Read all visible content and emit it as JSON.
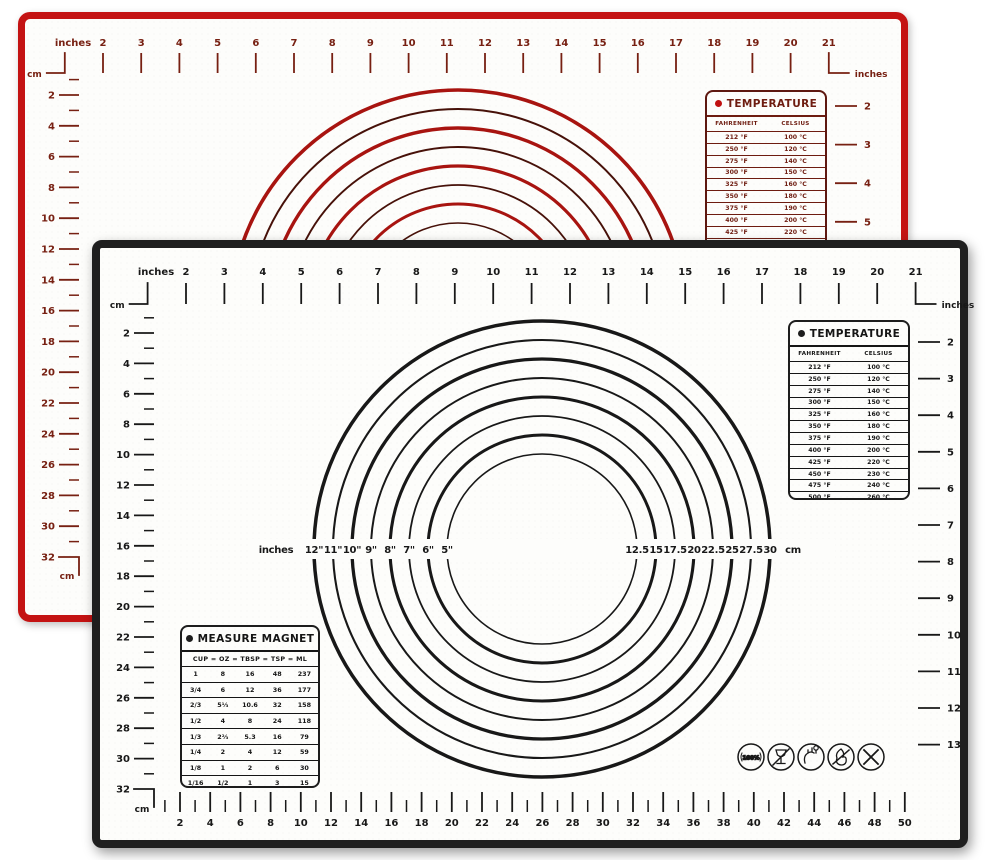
{
  "colors": {
    "red_border": "#c41313",
    "red_ink": "#772012",
    "red_circle_bright": "#a81410",
    "red_circle_dark": "#471109",
    "black_border": "#1f1f1f",
    "black_ink": "#181818",
    "mat_bg": "#fdfdfb"
  },
  "red_mat": {
    "top_ruler": {
      "unit_left": "inches",
      "corner_unit": "cm",
      "numbers": [
        "2",
        "3",
        "4",
        "5",
        "6",
        "7",
        "8",
        "9",
        "10",
        "11",
        "12",
        "13",
        "14",
        "15",
        "16",
        "17",
        "18",
        "19",
        "20",
        "21"
      ],
      "unit_right": "inches"
    },
    "left_ruler": {
      "numbers": [
        "2",
        "4",
        "6",
        "8",
        "10",
        "12",
        "14",
        "16",
        "18",
        "20",
        "22",
        "24",
        "26",
        "28",
        "30",
        "32"
      ],
      "unit": "cm"
    },
    "right_ruler": {
      "numbers": [
        "2",
        "3",
        "4",
        "5",
        "6",
        "7",
        "8",
        "9",
        "10",
        "11",
        "12",
        "13"
      ]
    },
    "temperature_table": {
      "title": "TEMPERATURE",
      "columns": [
        "FAHRENHEIT",
        "CELSIUS"
      ],
      "rows": [
        [
          "212 °F",
          "100 °C"
        ],
        [
          "250 °F",
          "120 °C"
        ],
        [
          "275 °F",
          "140 °C"
        ],
        [
          "300 °F",
          "150 °C"
        ],
        [
          "325 °F",
          "160 °C"
        ],
        [
          "350 °F",
          "180 °C"
        ],
        [
          "375 °F",
          "190 °C"
        ],
        [
          "400 °F",
          "200 °C"
        ],
        [
          "425 °F",
          "220 °C"
        ],
        [
          "450 °F",
          "230 °C"
        ],
        [
          "475 °F",
          "240 °C"
        ],
        [
          "500 °F",
          "260 °C"
        ]
      ]
    }
  },
  "black_mat": {
    "top_ruler": {
      "unit_left": "inches",
      "corner_unit": "cm",
      "numbers": [
        "2",
        "3",
        "4",
        "5",
        "6",
        "7",
        "8",
        "9",
        "10",
        "11",
        "12",
        "13",
        "14",
        "15",
        "16",
        "17",
        "18",
        "19",
        "20",
        "21"
      ],
      "unit_right": "inches"
    },
    "left_ruler": {
      "numbers": [
        "2",
        "4",
        "6",
        "8",
        "10",
        "12",
        "14",
        "16",
        "18",
        "20",
        "22",
        "24",
        "26",
        "28",
        "30",
        "32"
      ],
      "unit": "cm"
    },
    "right_ruler": {
      "numbers": [
        "2",
        "3",
        "4",
        "5",
        "6",
        "7",
        "8",
        "9",
        "10",
        "11",
        "12",
        "13"
      ]
    },
    "bottom_ruler": {
      "numbers": [
        "2",
        "4",
        "6",
        "8",
        "10",
        "12",
        "14",
        "16",
        "18",
        "20",
        "22",
        "24",
        "26",
        "28",
        "30",
        "32",
        "34",
        "36",
        "38",
        "40",
        "42",
        "44",
        "46",
        "48",
        "50"
      ]
    },
    "circle_labels": {
      "left_unit": "inches",
      "left": [
        "12\"",
        "11\"",
        "10\"",
        "9\"",
        "8\"",
        "7\"",
        "6\"",
        "5\""
      ],
      "right": [
        "12.5",
        "15",
        "17.5",
        "20",
        "22.5",
        "25",
        "27.5",
        "30"
      ],
      "right_unit": "cm"
    },
    "temperature_table": {
      "title": "TEMPERATURE",
      "columns": [
        "FAHRENHEIT",
        "CELSIUS"
      ],
      "rows": [
        [
          "212 °F",
          "100 °C"
        ],
        [
          "250 °F",
          "120 °C"
        ],
        [
          "275 °F",
          "140 °C"
        ],
        [
          "300 °F",
          "150 °C"
        ],
        [
          "325 °F",
          "160 °C"
        ],
        [
          "350 °F",
          "180 °C"
        ],
        [
          "375 °F",
          "190 °C"
        ],
        [
          "400 °F",
          "200 °C"
        ],
        [
          "425 °F",
          "220 °C"
        ],
        [
          "450 °F",
          "230 °C"
        ],
        [
          "475 °F",
          "240 °C"
        ],
        [
          "500 °F",
          "260 °C"
        ]
      ]
    },
    "measure_table": {
      "title": "MEASURE MAGNET",
      "header": "CUP = OZ = TBSP = TSP = ML",
      "rows": [
        [
          "1",
          "8",
          "16",
          "48",
          "237"
        ],
        [
          "3/4",
          "6",
          "12",
          "36",
          "177"
        ],
        [
          "2/3",
          "5⅓",
          "10.6",
          "32",
          "158"
        ],
        [
          "1/2",
          "4",
          "8",
          "24",
          "118"
        ],
        [
          "1/3",
          "2⅔",
          "5.3",
          "16",
          "79"
        ],
        [
          "1/4",
          "2",
          "4",
          "12",
          "59"
        ],
        [
          "1/8",
          "1",
          "2",
          "6",
          "30"
        ],
        [
          "1/16",
          "1/2",
          "1",
          "3",
          "15"
        ]
      ]
    },
    "icons": [
      {
        "label": "100%"
      },
      {
        "label": ""
      },
      {
        "label": ""
      },
      {
        "label": ""
      },
      {
        "label": ""
      }
    ]
  }
}
